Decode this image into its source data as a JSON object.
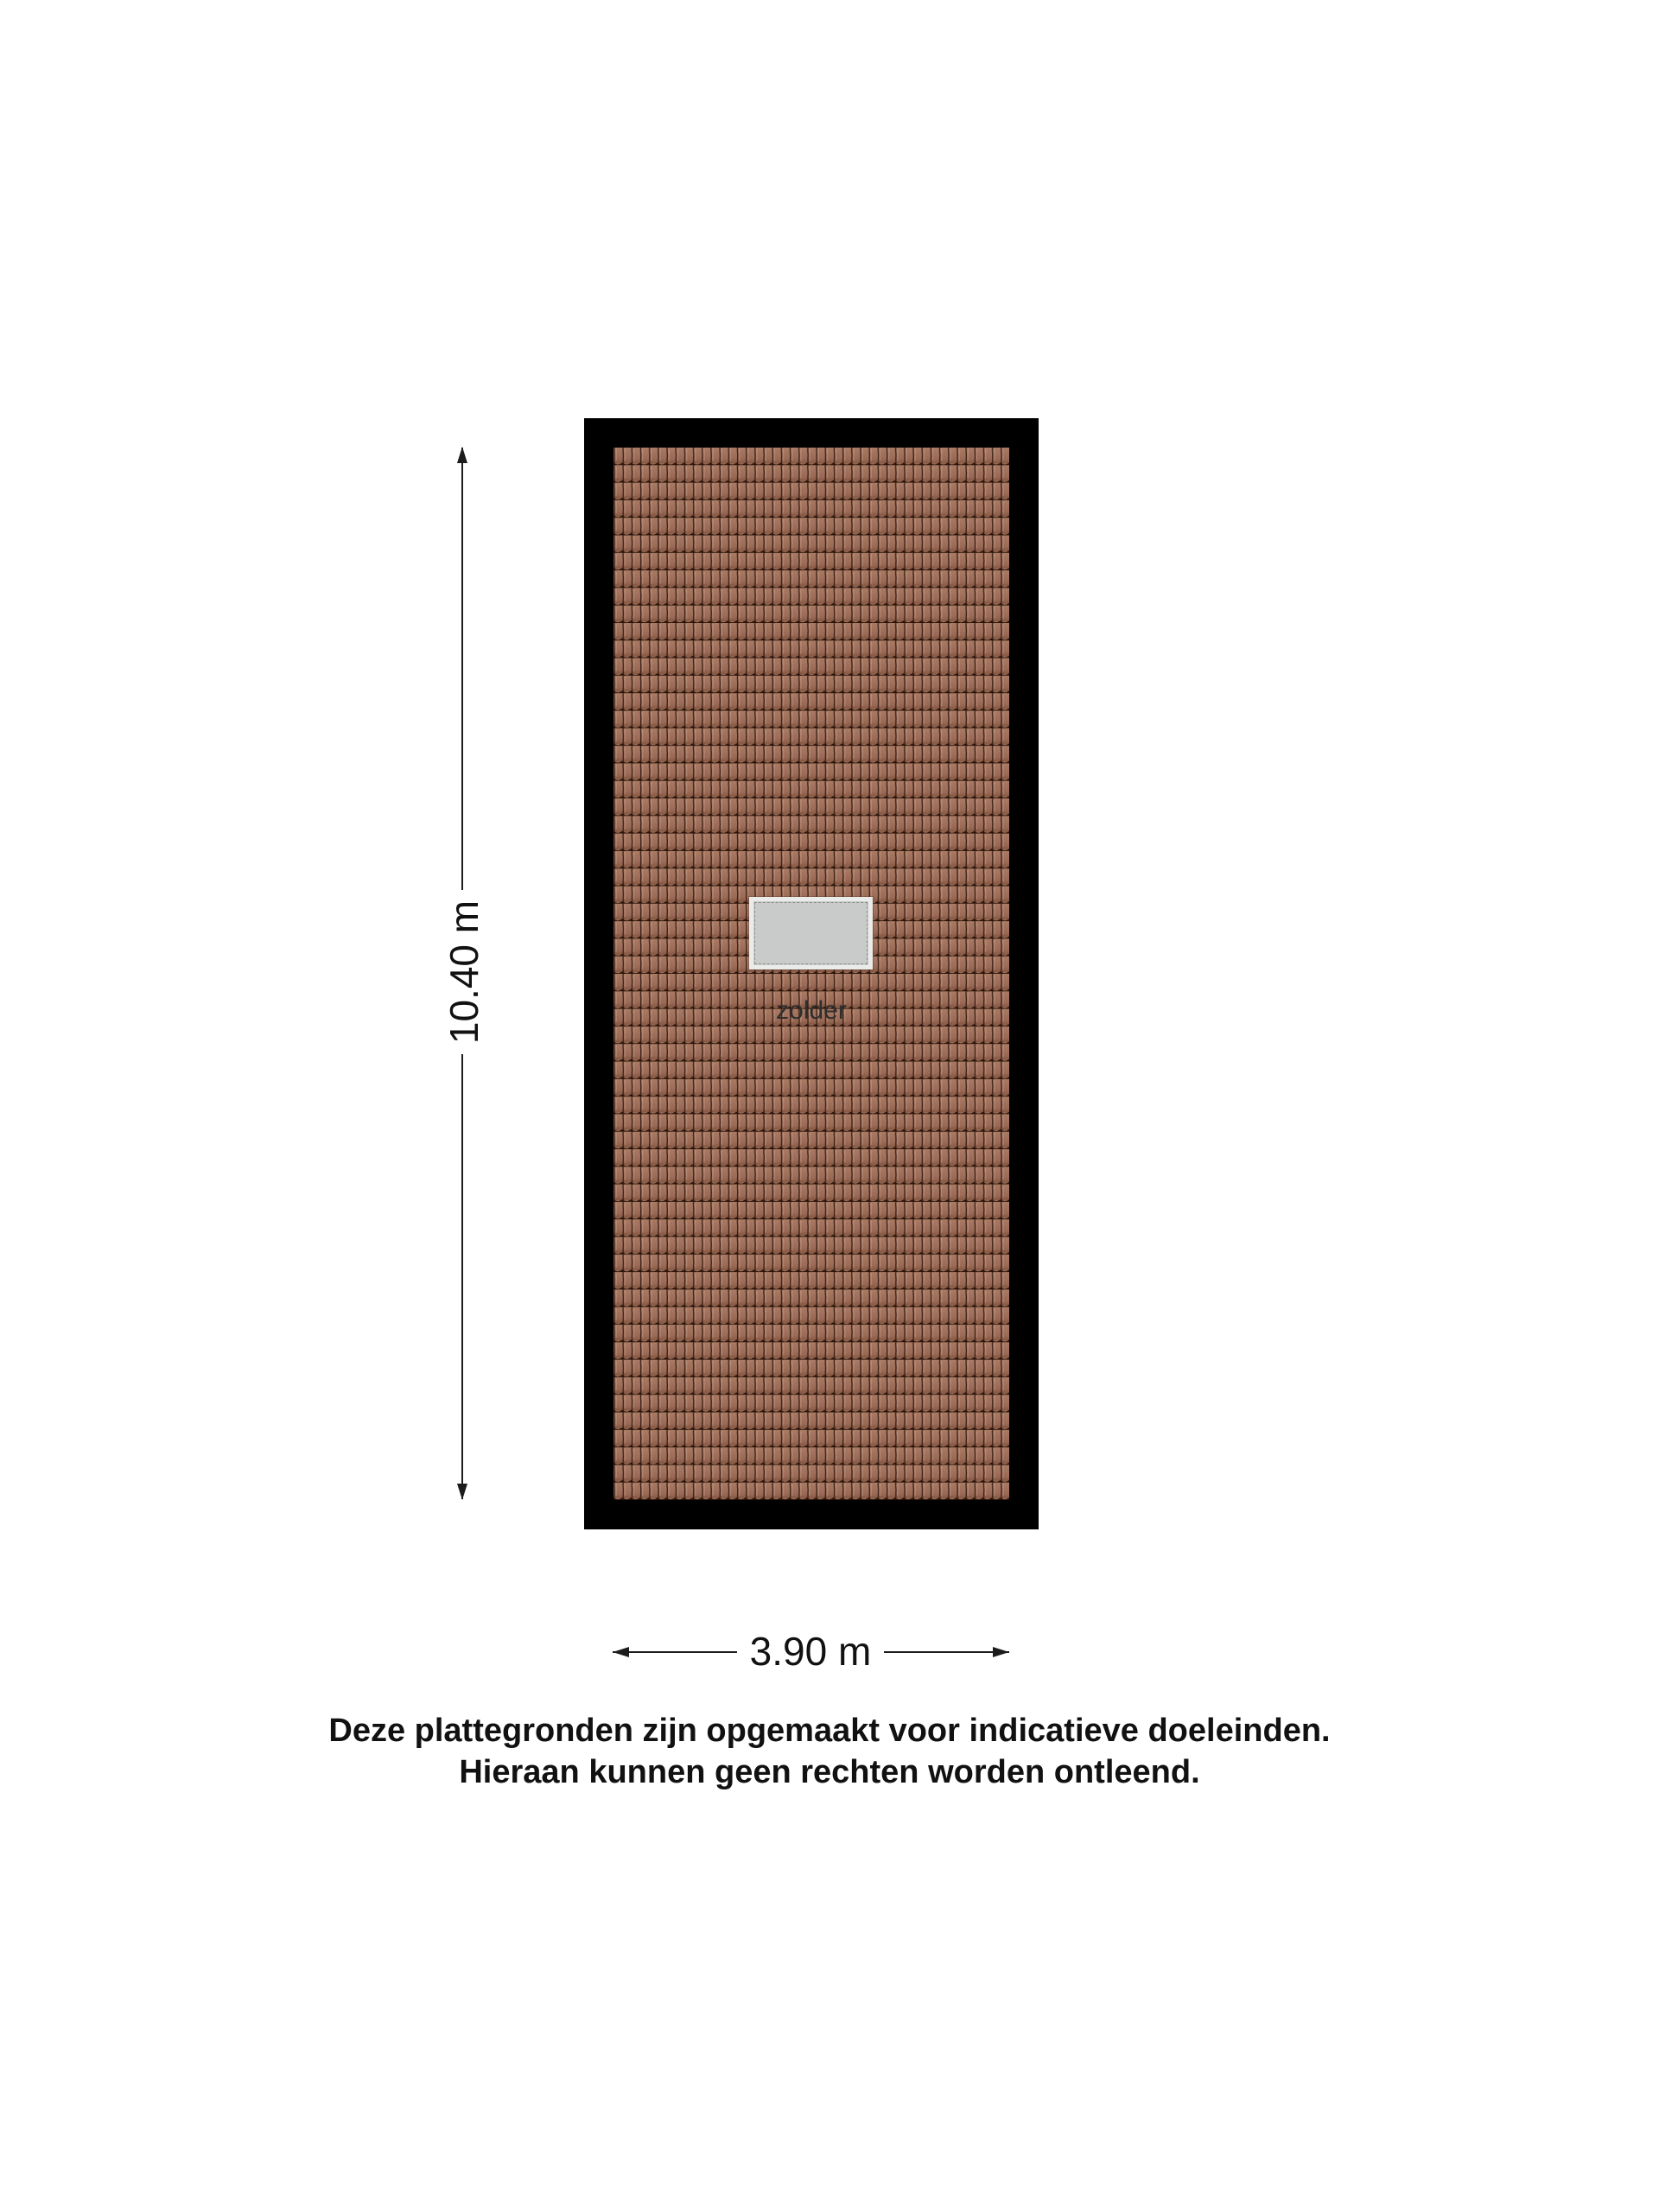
{
  "floorplan": {
    "room_label": "zolder",
    "vertical_dimension": "10.40 m",
    "horizontal_dimension": "3.90 m"
  },
  "disclaimer": {
    "line1": "Deze plattegronden zijn opgemaakt voor indicatieve doeleinden.",
    "line2": "Hieraan kunnen geen rechten worden ontleend."
  },
  "colors": {
    "background": "#ffffff",
    "wall": "#000000",
    "tile_light": "#a97a64",
    "tile_base": "#9a6a56",
    "tile_dark": "#855844",
    "tile_gap": "#2a140a",
    "skylight_frame": "#ebecea",
    "skylight_glass": "#c9cbca",
    "skylight_dash": "#8d908e",
    "dimension_line": "#1c1c1c",
    "text": "#111111",
    "room_text": "#2e2e2e"
  }
}
